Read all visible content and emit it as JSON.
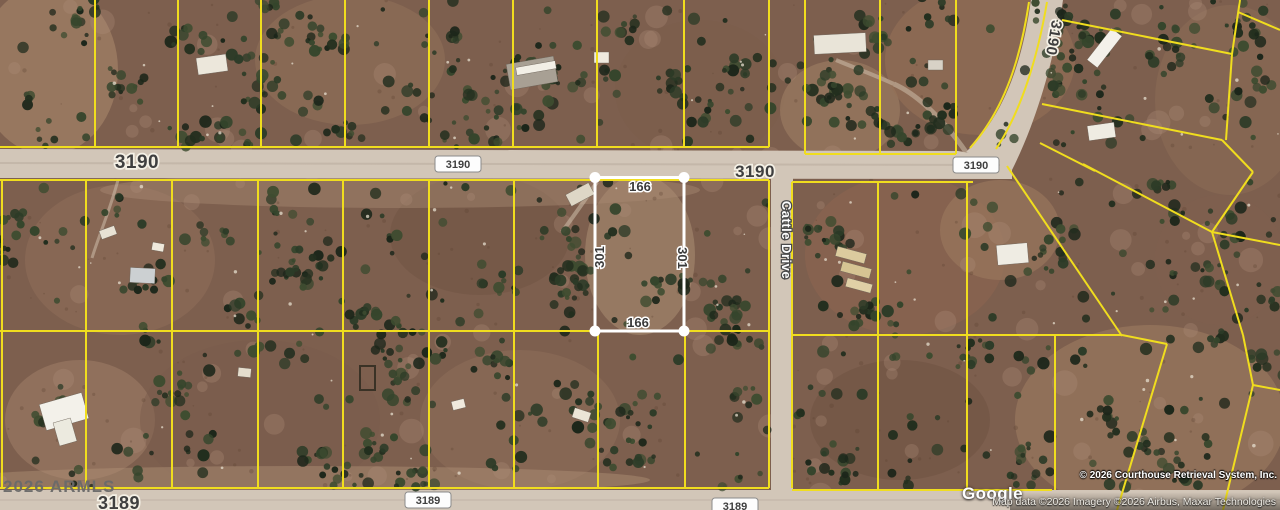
{
  "watermarks": {
    "armls": "2026 ARMLS",
    "crs": "© 2026 Courthouse Retrieval System, Inc.",
    "google": "Google",
    "map_attribution": "Map data ©2026 Imagery ©2026 Airbus, Maxar Technologies"
  },
  "highlighted_parcel": {
    "top_label": "166",
    "bottom_label": "166",
    "left_label": "301",
    "right_label": "301"
  },
  "road_labels": [
    {
      "id": "road-label-3190-left",
      "text": "3190",
      "style": "halo",
      "x": 137,
      "y": 168,
      "size": 19,
      "rotate": 0
    },
    {
      "id": "road-label-3190-bubble-mid",
      "text": "3190",
      "style": "bubble",
      "x": 458,
      "y": 168,
      "size": 11,
      "rotate": 0
    },
    {
      "id": "road-label-3190-right",
      "text": "3190",
      "style": "halo",
      "x": 755,
      "y": 177,
      "size": 17,
      "rotate": 0
    },
    {
      "id": "road-label-3190-bubble-right",
      "text": "3190",
      "style": "bubble",
      "x": 976,
      "y": 169,
      "size": 11,
      "rotate": 0
    },
    {
      "id": "road-label-3190-diagonal",
      "text": "3190",
      "style": "halo",
      "x": 1049,
      "y": 37,
      "size": 15,
      "rotate": 100
    },
    {
      "id": "road-label-cattle-drive",
      "text": "Cattle Drive",
      "style": "roadname",
      "x": 782,
      "y": 240,
      "size": 13,
      "rotate": 90
    },
    {
      "id": "road-label-3189-left",
      "text": "3189",
      "style": "halo",
      "x": 119,
      "y": 509,
      "size": 18,
      "rotate": 0
    },
    {
      "id": "road-label-3189-bubble-mid",
      "text": "3189",
      "style": "bubble",
      "x": 428,
      "y": 504,
      "size": 11,
      "rotate": 0
    },
    {
      "id": "road-label-3189-bubble-right",
      "text": "3189",
      "style": "bubble",
      "x": 735,
      "y": 510,
      "size": 11,
      "rotate": 0
    }
  ],
  "colors": {
    "parcel_line": "#f0dd1e",
    "highlight": "#ffffff",
    "road_fill": "#d2c6b8",
    "terrain_base": "#7d5f4e",
    "tree_dark": "#26331f",
    "label_dark": "#3f3f3f"
  }
}
